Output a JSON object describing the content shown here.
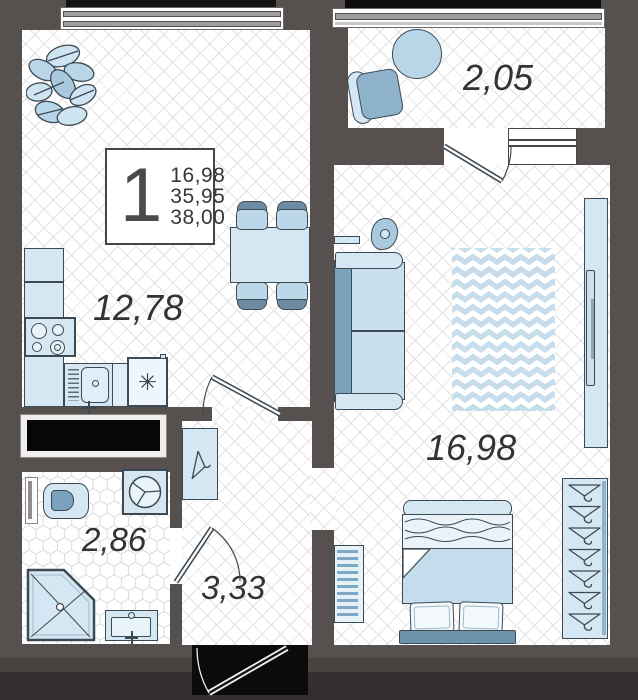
{
  "unit_card": {
    "rooms_count": "1",
    "values": [
      "16,98",
      "35,95",
      "38,00"
    ]
  },
  "room_labels": {
    "kitchen_living": "12,78",
    "balcony": "2,05",
    "bedroom_living": "16,98",
    "bathroom": "2,86",
    "hallway": "3,33"
  },
  "symbols": {
    "fridge_snowflake": "✳"
  },
  "colors": {
    "wall": "#56514e",
    "floor": "#ffffff",
    "furniture_light": "#d5e7f3",
    "furniture_mid": "#a9c9de",
    "furniture_dark": "#7ca3bd",
    "outline": "#3d4a54",
    "rug_base": "#c7ddec",
    "label_text": "#35322f"
  }
}
